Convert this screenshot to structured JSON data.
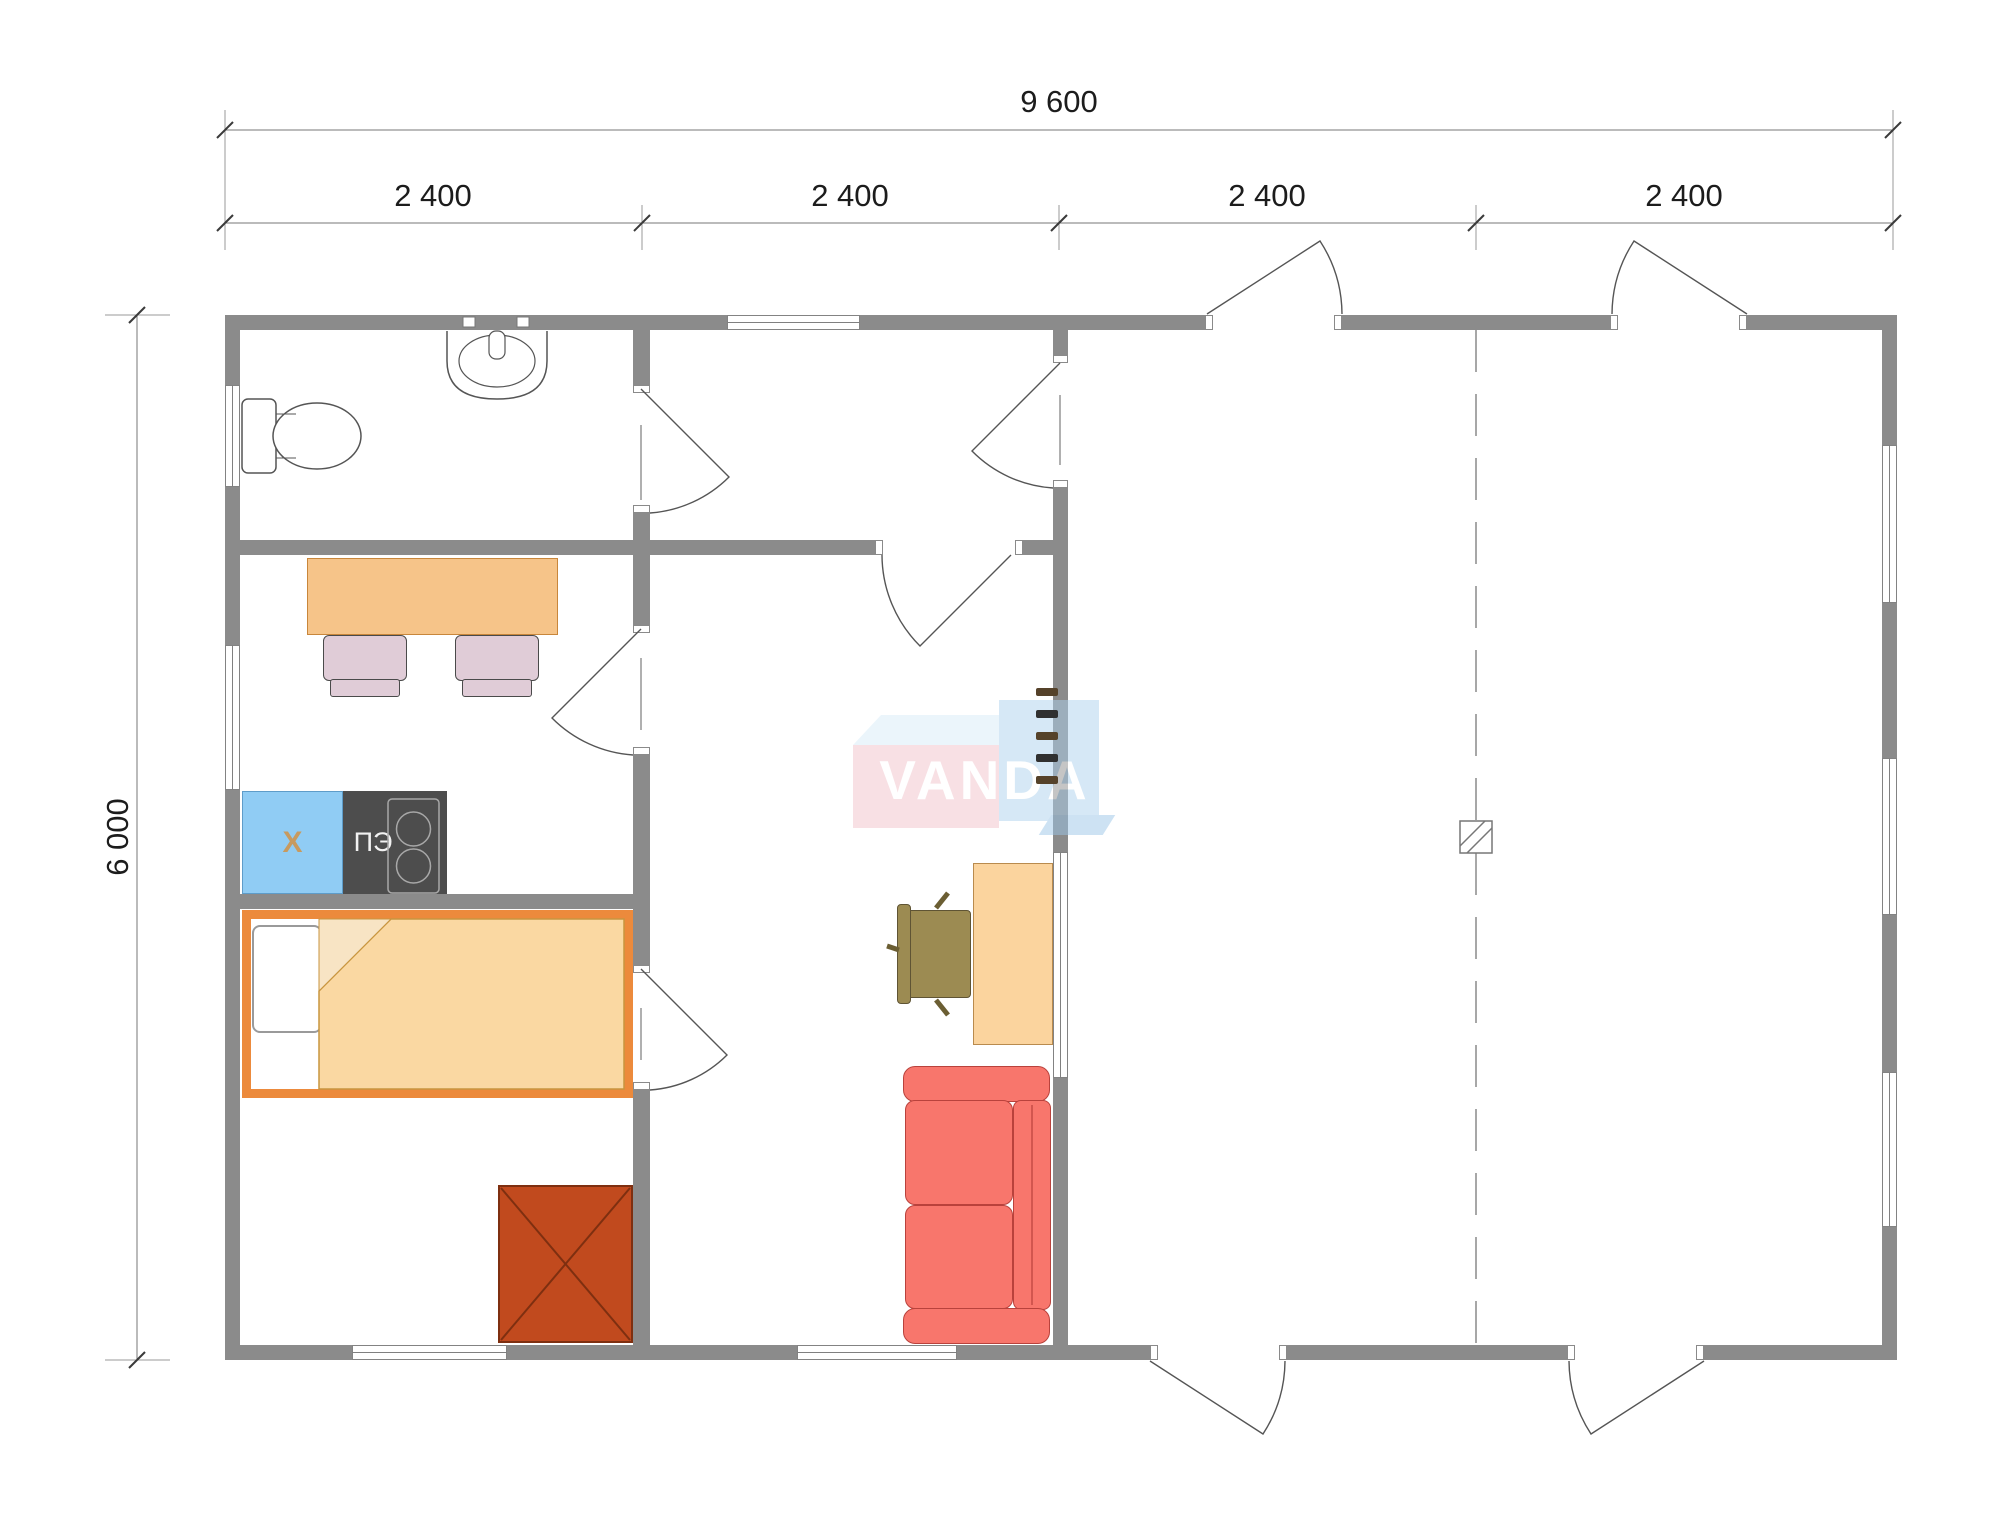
{
  "dimensions": {
    "total_width": "9 600",
    "segments": [
      "2 400",
      "2 400",
      "2 400",
      "2 400"
    ],
    "height": "6 000"
  },
  "appliances": {
    "fridge_label": "Х",
    "stove_label": "ПЭ"
  },
  "watermark": {
    "text": "VANDA"
  },
  "colors": {
    "wall": "#8B8B8B",
    "kitchen_table": "#F6C489",
    "kitchen_chair": "#E0CCD7",
    "fridge": "#90CCF4",
    "fridge_label": "#C79A5F",
    "stove": "#4D4D4D",
    "bed_frame": "#EC8A3C",
    "bed_blanket": "#FAD8A2",
    "wardrobe": "#C14A1E",
    "desk": "#FBD49E",
    "office_chair": "#9C8B52",
    "sofa": "#F8766C",
    "watermark_pink": "#F2C3CB",
    "watermark_blue": "#AED2EE",
    "watermark_top_face": "#D9EDF9"
  }
}
